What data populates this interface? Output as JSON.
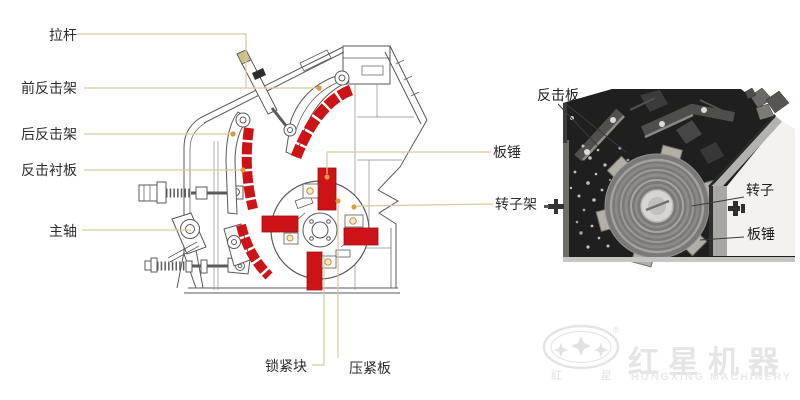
{
  "diagram": {
    "title_hint": "impact crusher section drawing",
    "labels": {
      "la_gan": "拉杆",
      "qian_fanjijia": "前反击架",
      "hou_fanjijia": "后反击架",
      "fanji_chenban": "反击衬板",
      "zhuzhou": "主轴",
      "suojinkuai": "锁紧块",
      "yajinban": "压紧板",
      "banchui": "板锤",
      "zhuanzijia": "转子架"
    }
  },
  "photo": {
    "labels": {
      "fanjiban": "反击板",
      "zhuanzi": "转子",
      "banchui": "板锤"
    }
  },
  "logo": {
    "brand_cn": "红星机器",
    "brand_en": "HONGXING MACHINERY",
    "seal_left": "红",
    "seal_right": "星",
    "registered": "®"
  },
  "colors": {
    "highlight_red": "#ce1317",
    "leader_line_tan": "#d9c9a0",
    "marker_orange": "#e2993b",
    "drawing_line": "#555555",
    "watermark_gray": "#e6e6e6",
    "photo_dark": "#1f1f1f"
  }
}
